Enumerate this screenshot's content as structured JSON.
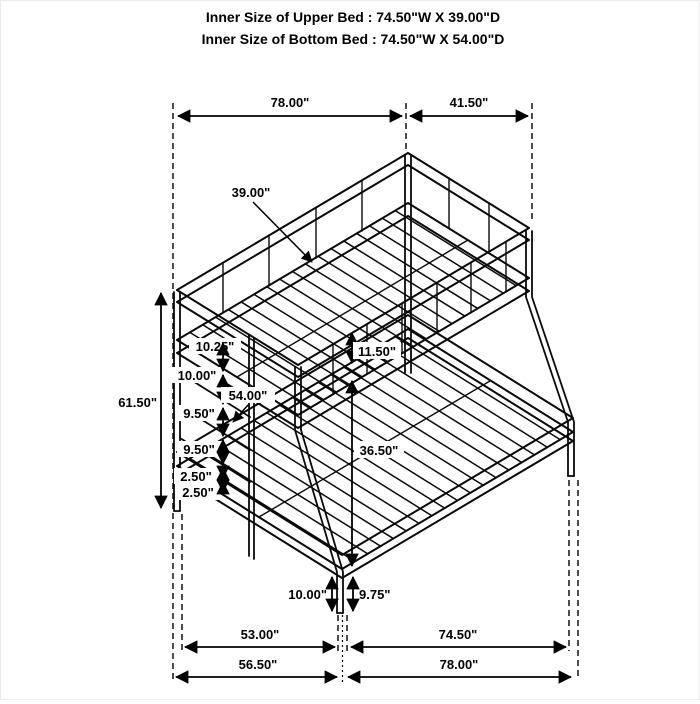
{
  "title": {
    "line1": "Inner Size of Upper Bed : 74.50\"W X 39.00\"D",
    "line2": "Inner Size of Bottom Bed : 74.50\"W X 54.00\"D"
  },
  "dimensions": {
    "top_width": "78.00\"",
    "top_depth": "41.50\"",
    "overall_height": "61.50\"",
    "ladder_spacings": [
      "10.25\"",
      "10.00\"",
      "9.50\"",
      "9.50\"",
      "2.50\"",
      "2.50\""
    ],
    "upper_bed_depth": "39.00\"",
    "lower_bed_width": "54.00\"",
    "bunk_gap": "11.50\"",
    "under_upper_clearance": "36.50\"",
    "front_leg_height": "10.00\"",
    "side_leg_height": "9.75\"",
    "bottom_inner_left": "53.00\"",
    "bottom_inner_right": "74.50\"",
    "bottom_outer_left": "56.50\"",
    "bottom_outer_right": "78.00\""
  },
  "colors": {
    "line": "#000000",
    "background": "#ffffff"
  }
}
